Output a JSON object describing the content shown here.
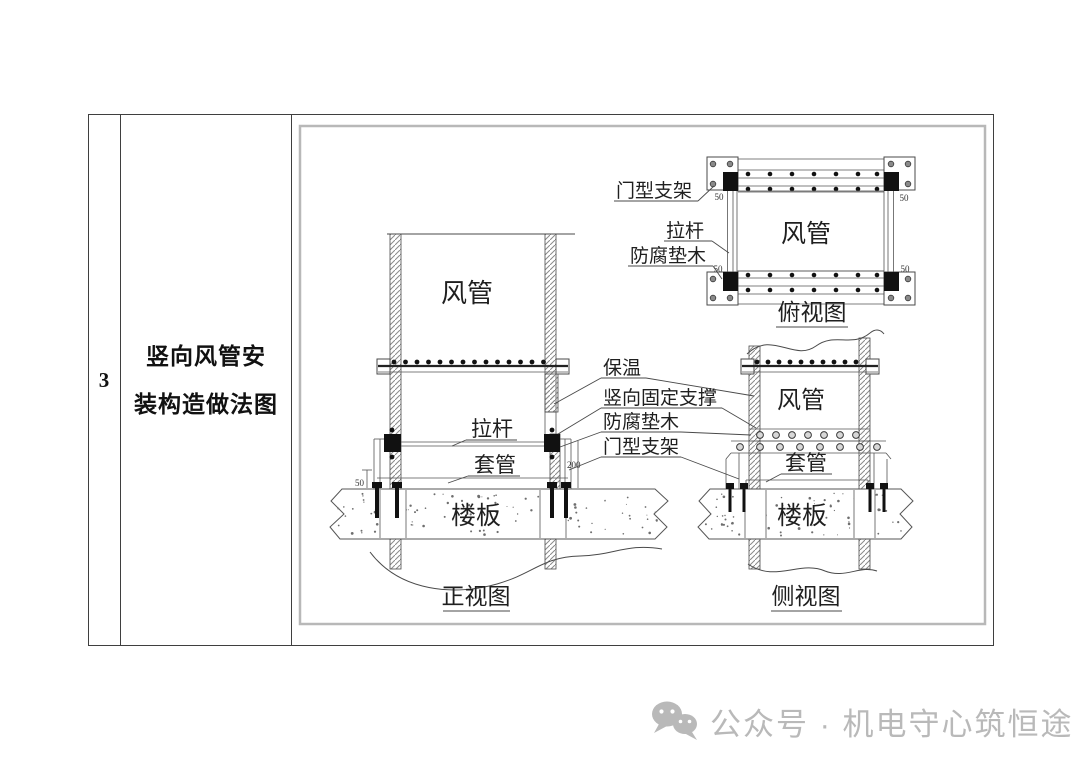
{
  "table": {
    "row_number": "3",
    "title_line1": "竖向风管安",
    "title_line2": "装构造做法图"
  },
  "diagram": {
    "labels": {
      "bracket": "门型支架",
      "tie_rod": "拉杆",
      "pad": "防腐垫木",
      "insulation": "保温",
      "vertical_support": "竖向固定支撑",
      "duct": "风管",
      "sleeve": "套管",
      "slab": "楼板"
    },
    "captions": {
      "top": "俯视图",
      "front": "正视图",
      "side": "侧视图"
    },
    "dims": {
      "d50": "50",
      "d200": "200"
    }
  },
  "watermark": {
    "text": "公众号 · 机电守心筑恒途",
    "icon": "wechat-icon"
  }
}
